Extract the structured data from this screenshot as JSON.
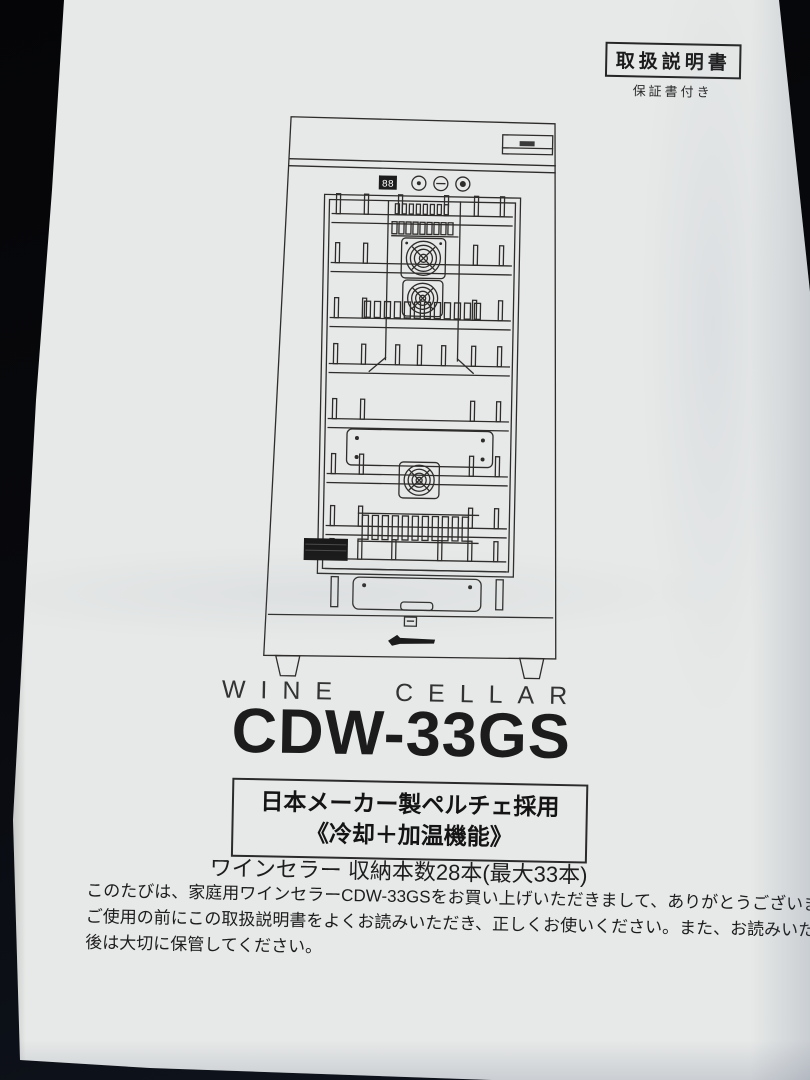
{
  "badge": {
    "title": "取扱説明書",
    "subtitle": "保証書付き"
  },
  "product": {
    "category_label": "WINE CELLAR",
    "model": "CDW-33GS",
    "feature_line1": "日本メーカー製ペルチェ採用",
    "feature_line2": "《冷却＋加温機能》",
    "capacity": "ワインセラー 収納本数28本(最大33本)"
  },
  "intro": {
    "line1": "このたびは、家庭用ワインセラーCDW-33GSをお買い上げいただきまして、ありがとうございます。",
    "line2": "ご使用の前にこの取扱説明書をよくお読みいただき、正しくお使いください。また、お読みいただいた",
    "line3": "後は大切に保管してください。"
  },
  "illustration": {
    "display_value": "88"
  },
  "colors": {
    "paper": "#e7e9e8",
    "ink": "#1d1d1d",
    "background": "#0a0b0f"
  }
}
